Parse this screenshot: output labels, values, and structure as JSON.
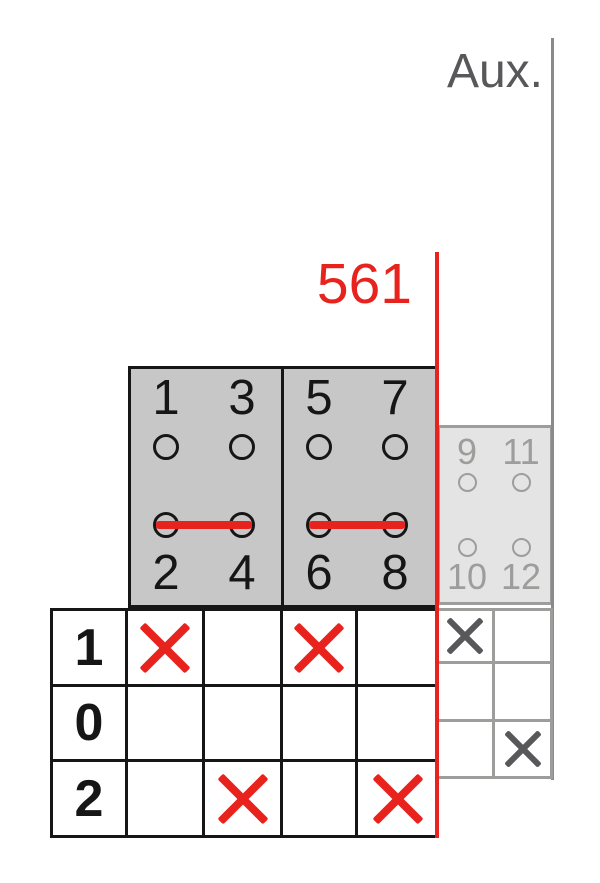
{
  "aux_label": "Aux.",
  "switch_number": "561",
  "colors": {
    "red": "#e8231e",
    "black": "#161616",
    "main_block_fill": "#c7c7c7",
    "aux_block_fill": "#e4e4e4",
    "aux_stroke": "#9d9d9c",
    "aux_dark_gray": "#58585a",
    "aux_line_gray": "#8a8a8a"
  },
  "main_contact_groups": [
    {
      "top_terminals": [
        "1",
        "3"
      ],
      "bottom_terminals": [
        "2",
        "4"
      ],
      "bridged_row": "bottom"
    },
    {
      "top_terminals": [
        "5",
        "7"
      ],
      "bottom_terminals": [
        "6",
        "8"
      ],
      "bridged_row": "bottom"
    }
  ],
  "aux_contact_group": {
    "top_terminals": [
      "9",
      "11"
    ],
    "bottom_terminals": [
      "10",
      "12"
    ],
    "bridged_row": "none"
  },
  "position_table": {
    "row_labels": [
      "1",
      "0",
      "2"
    ],
    "marks": [
      [
        true,
        false,
        true,
        false
      ],
      [
        false,
        false,
        false,
        false
      ],
      [
        false,
        true,
        false,
        true
      ]
    ]
  },
  "aux_position_table": {
    "marks": [
      [
        true,
        false
      ],
      [
        false,
        false
      ],
      [
        false,
        true
      ]
    ]
  }
}
